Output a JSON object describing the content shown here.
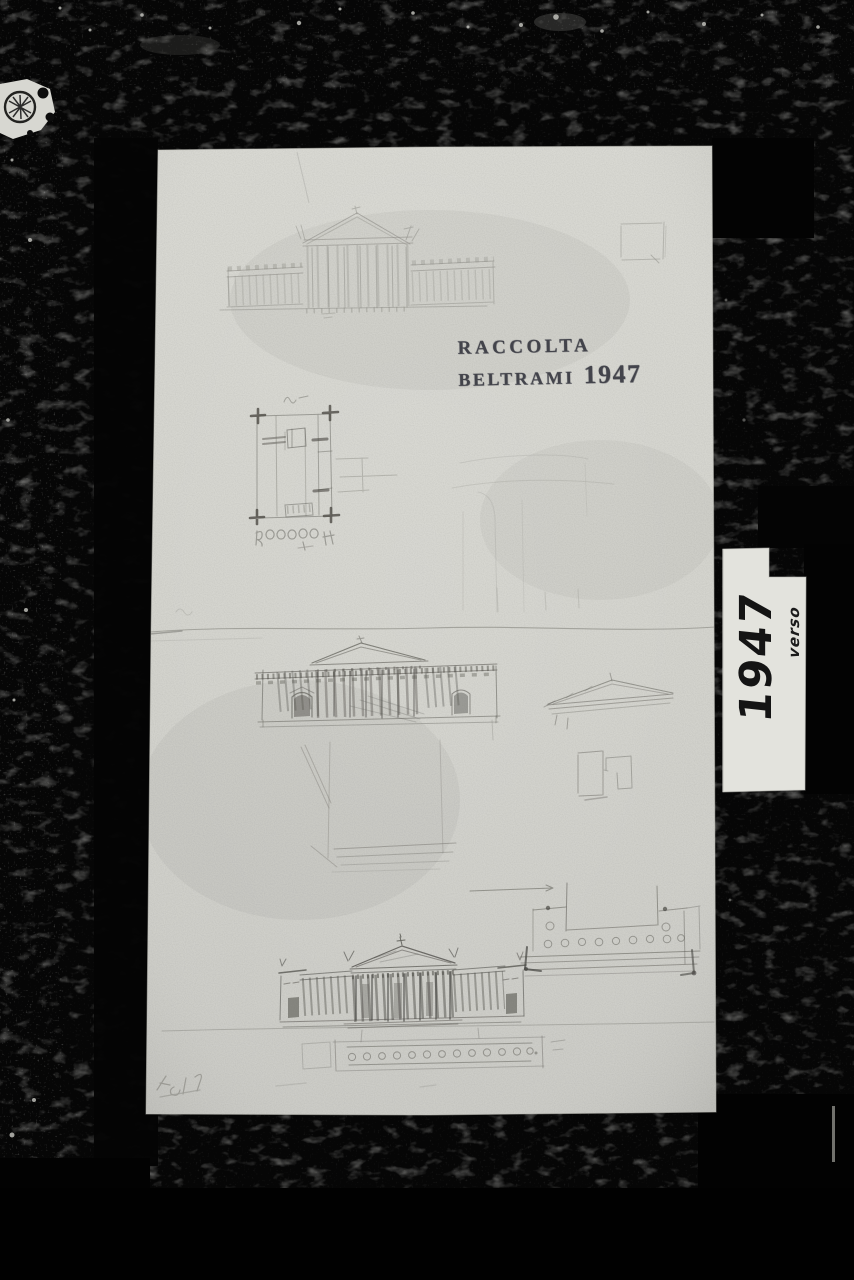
{
  "stamp": {
    "line1": "RACCOLTA",
    "line2": "BELTRAMI",
    "year": "1947"
  },
  "label": {
    "year": "1947",
    "note": "verso"
  },
  "colors": {
    "background": "#050505",
    "paper": "#d5d5cf",
    "label_paper": "#e3e3dd",
    "stamp_ink": "#30313a",
    "marker_ink": "#141414",
    "pencil": "#6f6e68"
  }
}
